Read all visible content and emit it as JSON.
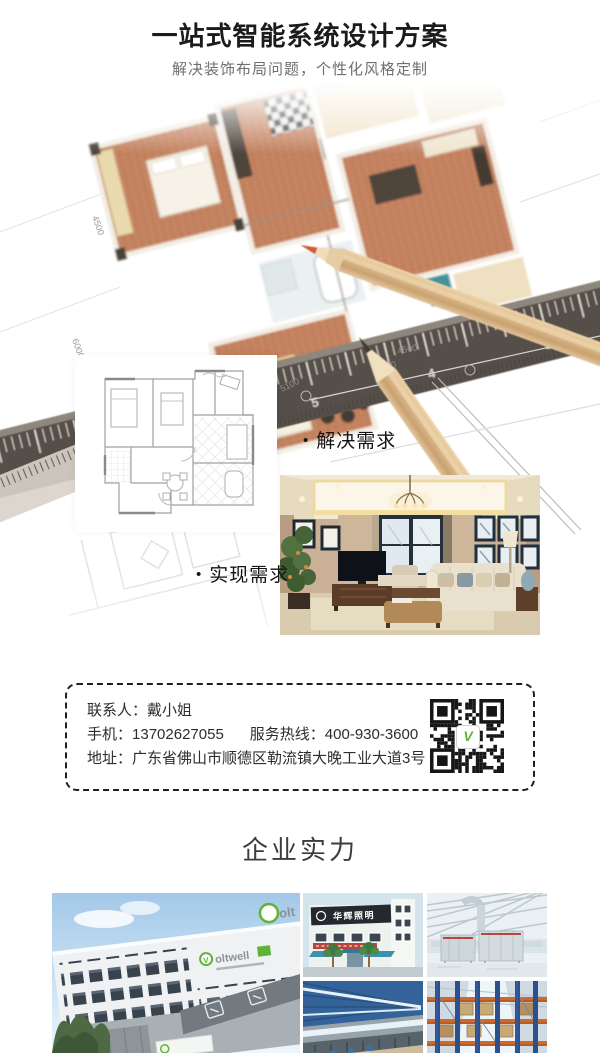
{
  "header": {
    "title": "一站式智能系统设计方案",
    "subtitle": "解决装饰布局问题，个性化风格定制"
  },
  "hero": {
    "dims": [
      "4500",
      "15500",
      "5100",
      "4500",
      "6000"
    ],
    "ruler_numbers": [
      "7",
      "6",
      "5",
      "4",
      "3",
      "2"
    ]
  },
  "steps": {
    "bullet": "•",
    "solve": "解决需求",
    "realize": "实现需求"
  },
  "contact": {
    "person_label": "联系人：",
    "person": "戴小姐",
    "phone_label": "手机：",
    "phone": "13702627055",
    "hotline_label": "服务热线：",
    "hotline": "400-930-3600",
    "address_label": "地址：",
    "address": "广东省佛山市顺德区勒流镇大晚工业大道3号",
    "qr_logo_initial": "V"
  },
  "strength": {
    "title": "企业实力"
  },
  "gallery": {
    "brand_initial": "V",
    "brand_rest": "oltwell",
    "brand_partial": "olt",
    "blue_building_sign": "华辉照明"
  },
  "colors": {
    "accent_green": "#5fb336",
    "text_dark": "#1b1b1b",
    "text_gray": "#6e6e6e"
  }
}
